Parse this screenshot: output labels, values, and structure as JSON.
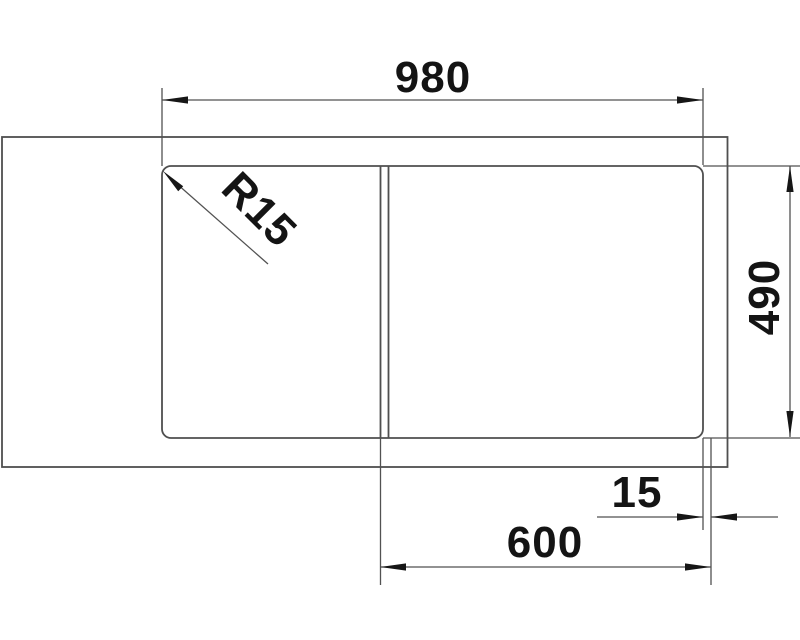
{
  "drawing": {
    "description": "Sink top-view dimension drawing",
    "labels": {
      "overall_width": "980",
      "depth": "490",
      "bowl_section_width": "600",
      "edge_offset": "15",
      "corner_radius": "R15"
    },
    "colors": {
      "object_line": "#4f4f4f",
      "dimension_line": "#525252",
      "ink": "#141414",
      "background": "#ffffff"
    }
  }
}
